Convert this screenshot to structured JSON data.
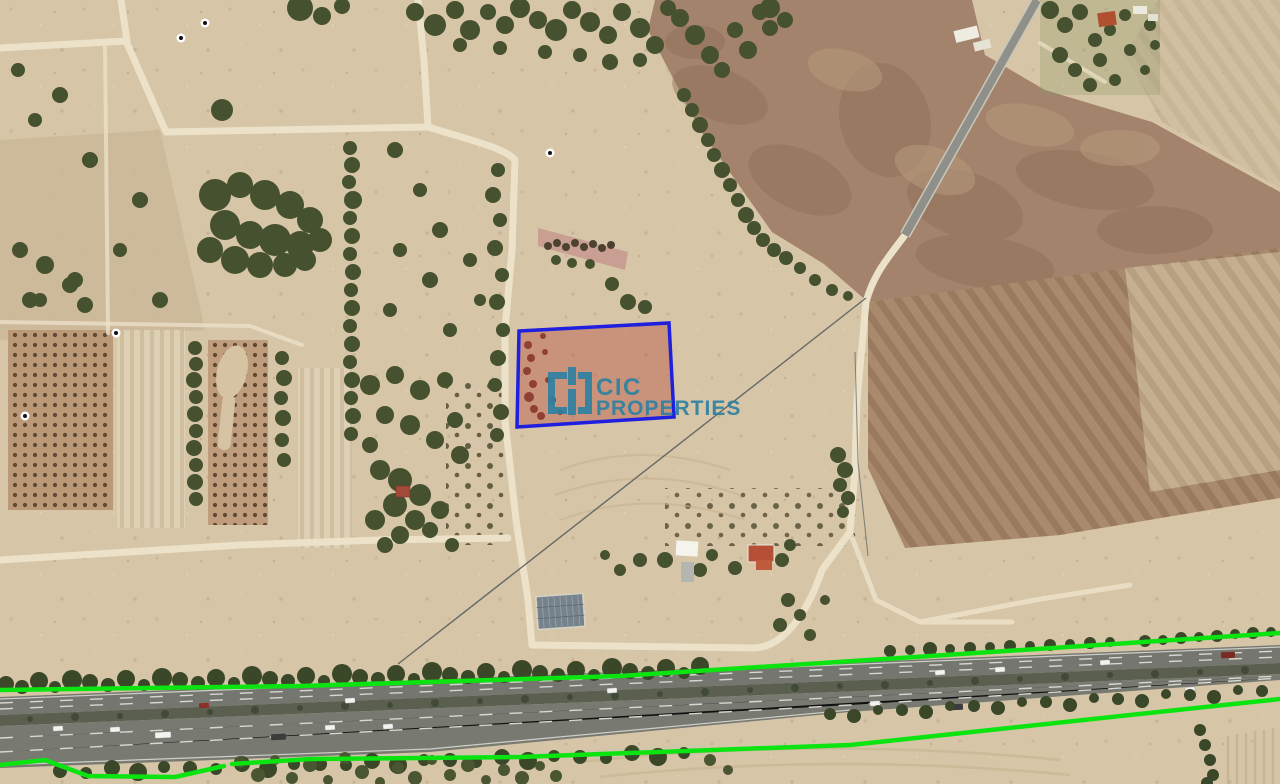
{
  "watermark": {
    "icon": "cic-brackets-logo-icon",
    "line1": "CIC",
    "line2": "PROPERTIES",
    "color": "#2E81A1"
  },
  "annotations": {
    "parcel": {
      "stroke": "#1F1FE0",
      "fill": "#B23F35",
      "fill_opacity": "0.38"
    },
    "highway_lines": {
      "color": "#0BE411"
    }
  }
}
